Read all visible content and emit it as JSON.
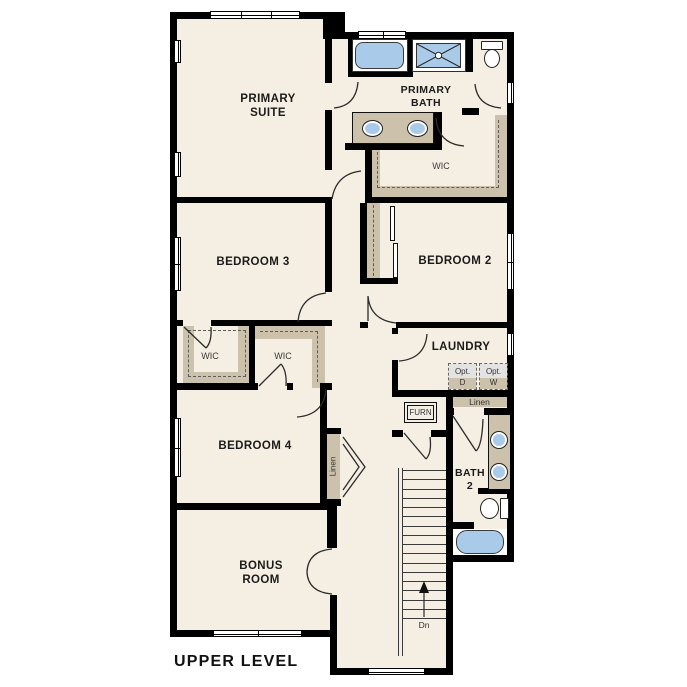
{
  "plan": {
    "title": "UPPER LEVEL"
  },
  "rooms": {
    "primary_suite": {
      "line1": "PRIMARY",
      "line2": "SUITE"
    },
    "primary_bath": {
      "line1": "PRIMARY",
      "line2": "BATH"
    },
    "primary_wic": "WIC",
    "bedroom3": "BEDROOM 3",
    "bedroom2": "BEDROOM 2",
    "wic_left": "WIC",
    "wic_right": "WIC",
    "laundry": "LAUNDRY",
    "bedroom4": "BEDROOM 4",
    "bonus_room": {
      "line1": "BONUS",
      "line2": "ROOM"
    },
    "bath2": {
      "line1": "BATH",
      "line2": "2"
    }
  },
  "closets": {
    "linen_hall": "Linen",
    "linen_laundry": "Linen"
  },
  "appliances": {
    "furnace": "FURN",
    "opt_dryer": {
      "line1": "Opt.",
      "line2": "D"
    },
    "opt_washer": {
      "line1": "Opt.",
      "line2": "W"
    }
  },
  "stairs": {
    "direction_label": "Dn",
    "tread_count": 17
  },
  "colors": {
    "floor": "#f5eee2",
    "wall": "#000000",
    "fixture_blue": "#a9cbe9",
    "shelf_tan": "#ccc1ab",
    "optional_gray": "#e3e3e3"
  }
}
